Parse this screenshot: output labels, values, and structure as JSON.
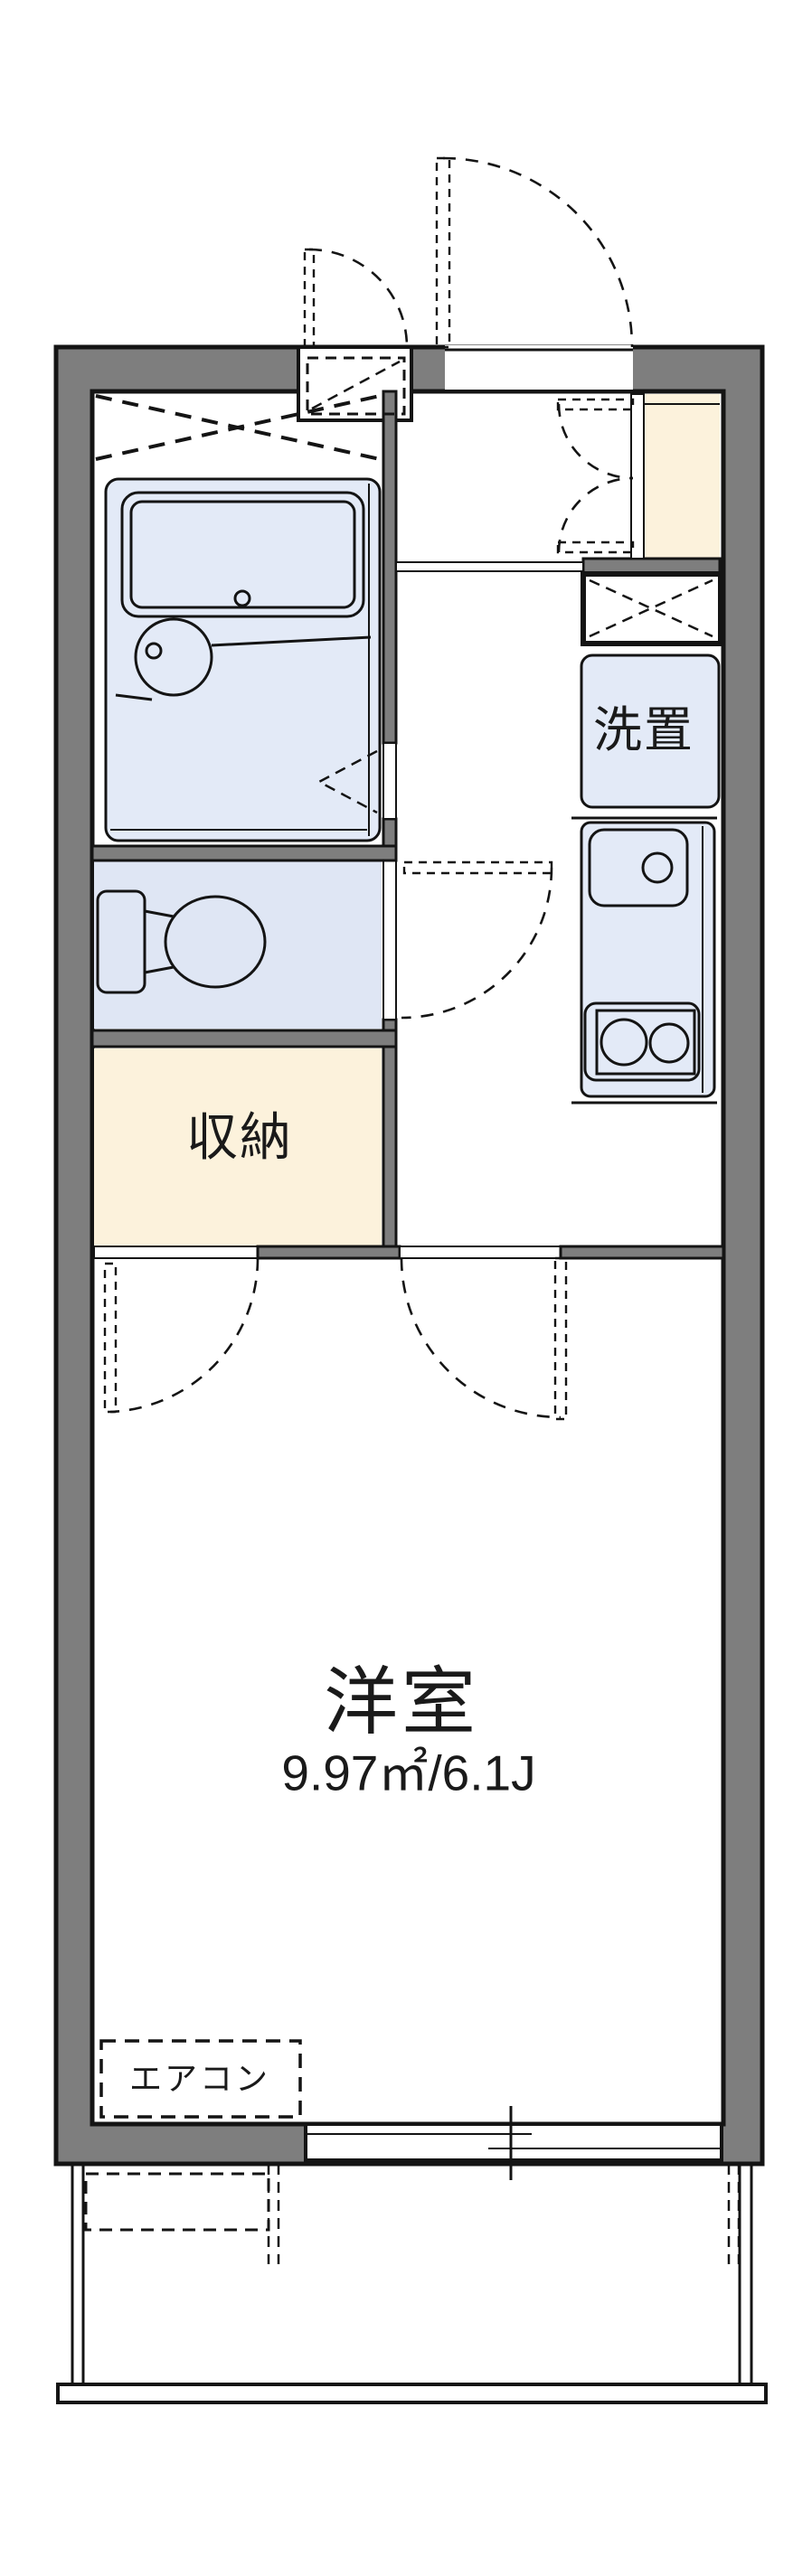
{
  "floorplan": {
    "labels": {
      "laundry": "洗置",
      "storage": "収納",
      "room_name": "洋室",
      "room_area": "9.97㎡/6.1J",
      "aircon": "エアコン"
    },
    "fixtures": [
      "entrance-door",
      "meter-box",
      "genkan",
      "shoe-storage-double-doors",
      "pipe-space",
      "washing-machine-space",
      "kitchen-sink",
      "gas-stove",
      "unit-bath",
      "bathtub",
      "washbasin",
      "bath-folding-door",
      "toilet",
      "toilet-door",
      "closet-door",
      "room-door",
      "air-conditioner",
      "sliding-window",
      "balcony"
    ],
    "colors": {
      "wall": "#7e7e7e",
      "outline": "#141414",
      "fixture_fill": "#e3eaf7",
      "closet_fill": "#fcf2dc",
      "background": "#ffffff"
    }
  }
}
